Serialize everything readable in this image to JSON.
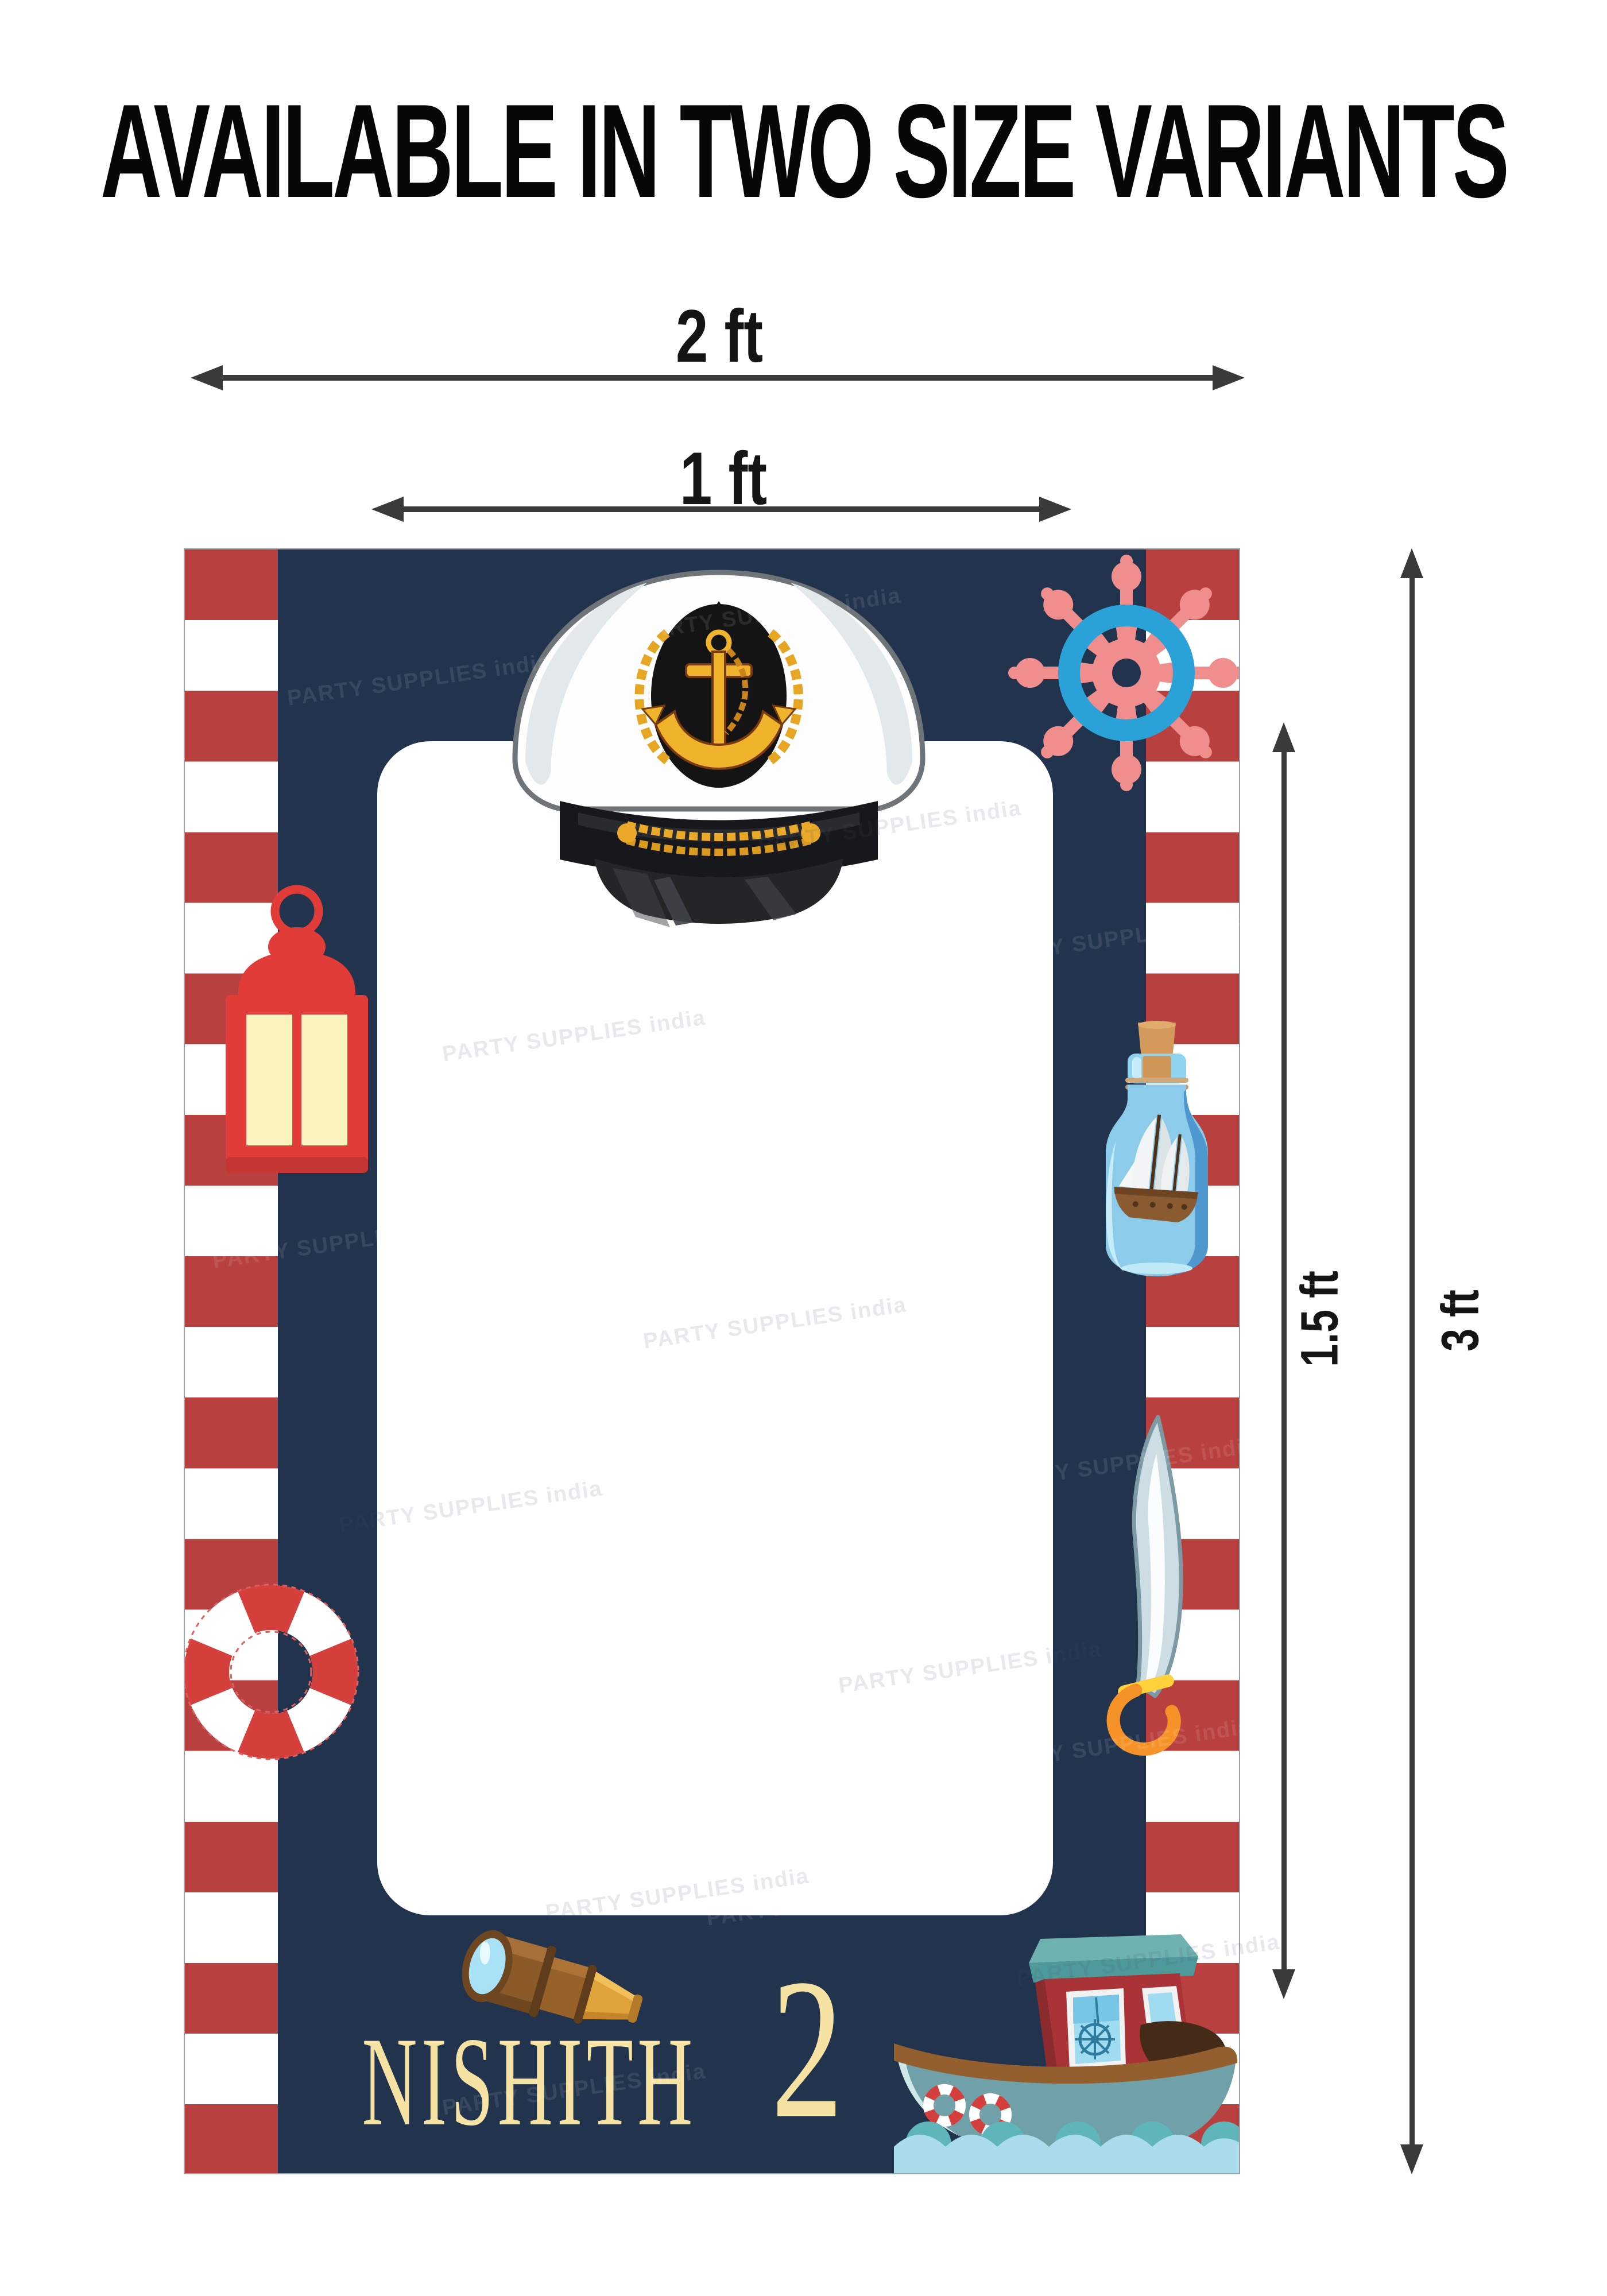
{
  "title": "AVAILABLE IN TWO SIZE VARIANTS",
  "dimension_labels": {
    "outer_width": "2 ft",
    "inner_width": "1 ft",
    "inner_height": "1.5 ft",
    "outer_height": "3 ft"
  },
  "frame": {
    "child_name": "NISHITH",
    "age": "2"
  },
  "watermark": {
    "text": "PARTY SUPPLIES india"
  },
  "icons": [
    "captain-hat-icon",
    "ship-wheel-icon",
    "lantern-icon",
    "ship-in-bottle-icon",
    "lifebuoy-icon",
    "cutlass-sword-icon",
    "telescope-icon",
    "fishing-boat-icon"
  ],
  "colors": {
    "navy": "#22334d",
    "stripe-red": "#b8413f",
    "cream": "#f6e3a4",
    "arrow-dark": "#3a3a3a",
    "wheel-pink": "#ef8e8c",
    "wheel-blue": "#2aa2d8",
    "lantern-red": "#e23c38",
    "buoy-red": "#d6403c",
    "boat-teal": "#70a1a8",
    "wave-blue": "#aadcee"
  }
}
